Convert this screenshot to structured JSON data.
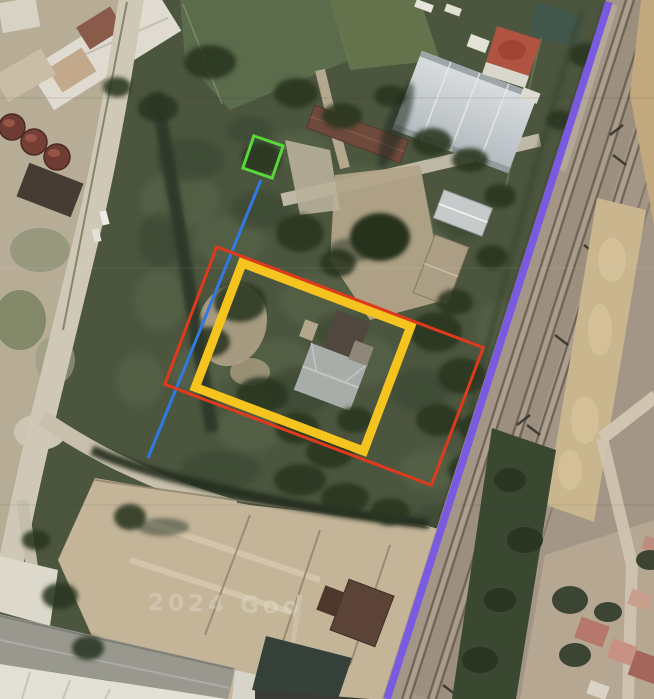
{
  "map": {
    "watermark": "2024 Goo",
    "colors": {
      "purple_line": "#7B5AE2",
      "red_outline": "#E03A1C",
      "yellow_outline": "#F6C41F",
      "green_outline": "#58D63A",
      "blue_line": "#3079E3"
    }
  },
  "annotations": [
    {
      "id": "purple-boundary-line",
      "type": "line",
      "x1": 609,
      "y1": 2,
      "x2": 387,
      "y2": 699,
      "width": 7.5,
      "color": "#7B5AE2"
    },
    {
      "id": "blue-connector-line",
      "type": "line",
      "x1": 261,
      "y1": 180,
      "x2": 148,
      "y2": 458,
      "width": 3,
      "color": "#3079E3"
    },
    {
      "id": "yellow-building-outline",
      "type": "rect",
      "cx": 303,
      "cy": 357,
      "w": 180,
      "h": 133,
      "angle": 20.7,
      "stroke": 9,
      "color": "#F6C41F"
    },
    {
      "id": "red-parcel-outline",
      "type": "rect",
      "cx": 324,
      "cy": 366,
      "w": 285,
      "h": 147,
      "angle": 20.7,
      "stroke": 3,
      "color": "#E03A1C"
    },
    {
      "id": "green-structure-outline",
      "type": "rect",
      "cx": 263,
      "cy": 157,
      "w": 31,
      "h": 34,
      "angle": 19,
      "stroke": 3,
      "color": "#58D63A"
    }
  ]
}
